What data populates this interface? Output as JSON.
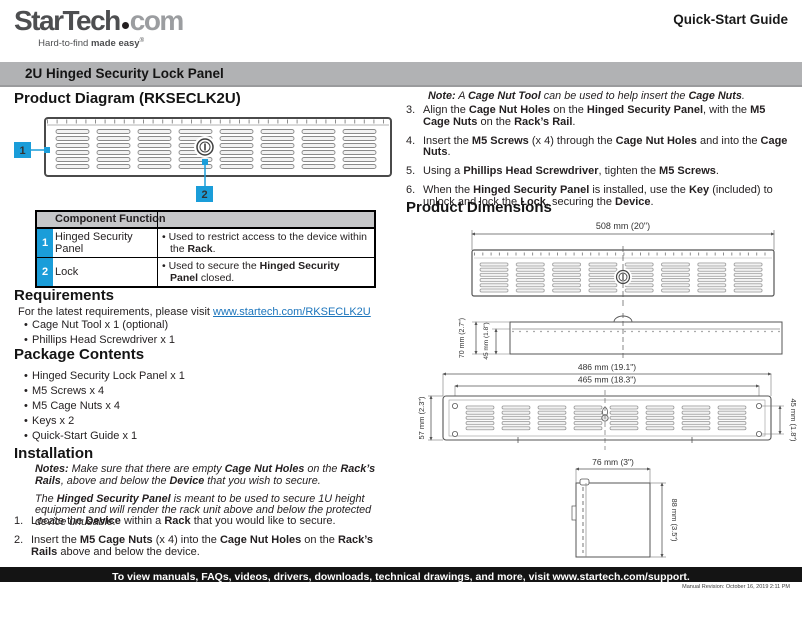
{
  "chars": {
    "bullet": "•",
    "reg": "®"
  },
  "header": {
    "logo_star": "Star",
    "logo_tech": "Tech",
    "logo_com": "com",
    "tagline": [
      [
        "Hard-to-find ",
        ""
      ],
      [
        "made easy",
        "b"
      ]
    ],
    "doc_type": "Quick-Start Guide"
  },
  "banner": {
    "title": "2U Hinged Security Lock Panel"
  },
  "product_diagram": {
    "heading": "Product Diagram (RKSECLK2U)",
    "callout_1": "1",
    "callout_2": "2"
  },
  "component_table": {
    "header": "Component Function",
    "rows": [
      {
        "num": "1",
        "component": "Hinged Security Panel",
        "function": [
          [
            "•  Used to restrict access to the device within the ",
            ""
          ],
          [
            "Rack",
            "b"
          ],
          [
            ".",
            ""
          ]
        ]
      },
      {
        "num": "2",
        "component": "Lock",
        "function": [
          [
            "•  Used to secure the ",
            ""
          ],
          [
            "Hinged Security Panel",
            "b"
          ],
          [
            " closed.",
            ""
          ]
        ]
      }
    ]
  },
  "requirements": {
    "heading": "Requirements",
    "intro": [
      [
        "For the latest requirements, please visit ",
        ""
      ]
    ],
    "link": "www.startech.com/RKSECLK2U",
    "items": [
      "Cage Nut Tool x 1 (optional)",
      "Phillips Head Screwdriver x 1"
    ]
  },
  "package_contents": {
    "heading": "Package Contents",
    "items": [
      "Hinged Security Lock Panel x 1",
      "M5 Screws x 4",
      "M5 Cage Nuts x 4",
      "Keys x 2",
      "Quick-Start Guide x 1"
    ]
  },
  "installation": {
    "heading": "Installation",
    "notes": [
      [
        [
          "Notes:",
          "bi"
        ],
        [
          " Make sure that there are empty ",
          "i"
        ],
        [
          "Cage Nut Holes",
          "bi"
        ],
        [
          " on the ",
          "i"
        ],
        [
          "Rack’s Rails",
          "bi"
        ],
        [
          ", above and below the ",
          "i"
        ],
        [
          "Device",
          "bi"
        ],
        [
          " that you wish to secure.",
          "i"
        ]
      ],
      [
        [
          "The ",
          "i"
        ],
        [
          "Hinged Security Panel",
          "bi"
        ],
        [
          " is meant to be used to secure 1U height equipment and will render the rack unit above and below the protected device unusable.",
          "i"
        ]
      ]
    ],
    "steps": [
      {
        "num": "1.",
        "segments": [
          [
            "Locate the ",
            ""
          ],
          [
            "Device",
            "b"
          ],
          [
            " within a ",
            ""
          ],
          [
            "Rack",
            "b"
          ],
          [
            " that you would like to secure.",
            ""
          ]
        ]
      },
      {
        "num": "2.",
        "segments": [
          [
            "Insert the ",
            ""
          ],
          [
            "M5 Cage Nuts",
            "b"
          ],
          [
            " (x 4) into the ",
            ""
          ],
          [
            "Cage Nut Holes",
            "b"
          ],
          [
            " on the ",
            ""
          ],
          [
            "Rack’s Rails",
            "b"
          ],
          [
            " above and below the device.",
            ""
          ]
        ]
      }
    ],
    "note_right": [
      [
        "Note:",
        "bi"
      ],
      [
        " A ",
        "i"
      ],
      [
        "Cage Nut Tool",
        "bi"
      ],
      [
        " can be used to help insert the ",
        "i"
      ],
      [
        "Cage Nuts",
        "bi"
      ],
      [
        ".",
        "i"
      ]
    ],
    "steps_right": [
      {
        "num": "3.",
        "segments": [
          [
            "Align the ",
            ""
          ],
          [
            "Cage Nut Holes",
            "b"
          ],
          [
            " on the ",
            ""
          ],
          [
            "Hinged Security Panel",
            "b"
          ],
          [
            ", with the ",
            ""
          ],
          [
            "M5 Cage Nuts",
            "b"
          ],
          [
            " on the ",
            ""
          ],
          [
            "Rack’s Rail",
            "b"
          ],
          [
            ".",
            ""
          ]
        ]
      },
      {
        "num": "4.",
        "segments": [
          [
            "Insert the ",
            ""
          ],
          [
            "M5 Screws",
            "b"
          ],
          [
            " (x 4) through the ",
            ""
          ],
          [
            "Cage Nut Holes",
            "b"
          ],
          [
            " and into the ",
            ""
          ],
          [
            "Cage Nuts",
            "b"
          ],
          [
            ".",
            ""
          ]
        ]
      },
      {
        "num": "5.",
        "segments": [
          [
            "Using a ",
            ""
          ],
          [
            "Phillips Head Screwdriver",
            "b"
          ],
          [
            ", tighten the ",
            ""
          ],
          [
            "M5 Screws",
            "b"
          ],
          [
            ".",
            ""
          ]
        ]
      },
      {
        "num": "6.",
        "segments": [
          [
            "When the ",
            ""
          ],
          [
            "Hinged Security Panel",
            "b"
          ],
          [
            " is installed, use the ",
            ""
          ],
          [
            "Key",
            "b"
          ],
          [
            " (included) to unlock and lock the ",
            ""
          ],
          [
            "Lock",
            "b"
          ],
          [
            ", securing the ",
            ""
          ],
          [
            "Device",
            "b"
          ],
          [
            ".",
            ""
          ]
        ]
      }
    ]
  },
  "dimensions": {
    "heading": "Product Dimensions",
    "front_width": "508 mm (20\")",
    "top_depth": "70 mm (2.7\")",
    "top_inner": "45 mm (1.8\")",
    "rear_width_outer": "486 mm (19.1\")",
    "rear_width_inner": "465 mm (18.3\")",
    "rear_height_left": "57 mm (2.3\")",
    "rear_height_right": "45 mm (1.8\")",
    "side_width": "76 mm (3\")",
    "side_height": "88 mm (3.5\")"
  },
  "footer": {
    "support_line": "To view manuals, FAQs, videos, drivers, downloads, technical drawings, and more, visit www.startech.com/support.",
    "revision": "Manual Revision: October 16, 2019 2:11 PM"
  },
  "colors": {
    "accent_blue": "#1a9dd9",
    "banner_gray": "#b1b2b4",
    "link_blue": "#1c75bc"
  }
}
